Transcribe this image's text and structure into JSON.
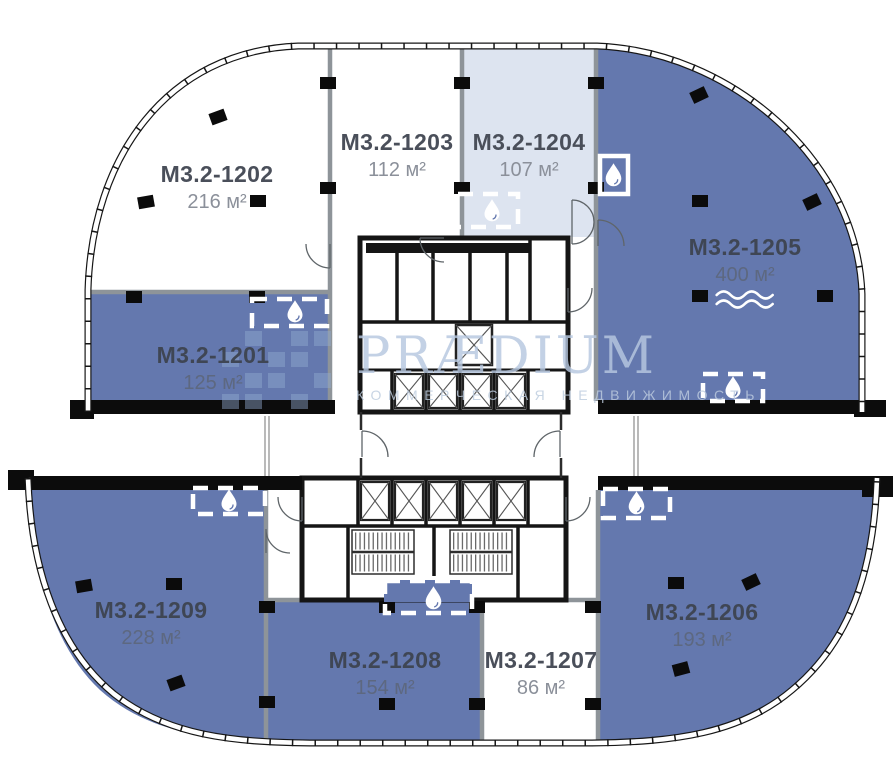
{
  "watermark": {
    "title": "PRÆDIUM",
    "subtitle": "КОММЕРЧЕСКАЯ НЕДВИЖИМОСТЬ",
    "logo": "praedium-pixel-grid-logo"
  },
  "colors": {
    "available": "#6478ae",
    "highlight": "#dde4f0",
    "vacant": "#ffffff",
    "wall_gray": "#8e9499",
    "wall_black": "#141414",
    "unit_name_text": "#454b58",
    "unit_area_text": "#8b909a",
    "watermark_blue": "#b7c8e0"
  },
  "icons": {
    "wet_zone": "water-drop-icon",
    "water_feature": "waves-icon",
    "column": "column-marker",
    "elevator": "elevator-shaft-x",
    "stairs": "staircase"
  },
  "units": [
    {
      "name": "M3.2-1201",
      "area": "125 м²",
      "status": "available"
    },
    {
      "name": "M3.2-1202",
      "area": "216 м²",
      "status": "vacant"
    },
    {
      "name": "M3.2-1203",
      "area": "112 м²",
      "status": "vacant"
    },
    {
      "name": "M3.2-1204",
      "area": "107 м²",
      "status": "highlighted"
    },
    {
      "name": "M3.2-1205",
      "area": "400 м²",
      "status": "available",
      "feature": "waves-icon"
    },
    {
      "name": "M3.2-1206",
      "area": "193 м²",
      "status": "available"
    },
    {
      "name": "M3.2-1207",
      "area": "86 м²",
      "status": "vacant"
    },
    {
      "name": "M3.2-1208",
      "area": "154 м²",
      "status": "available"
    },
    {
      "name": "M3.2-1209",
      "area": "228 м²",
      "status": "available"
    }
  ]
}
